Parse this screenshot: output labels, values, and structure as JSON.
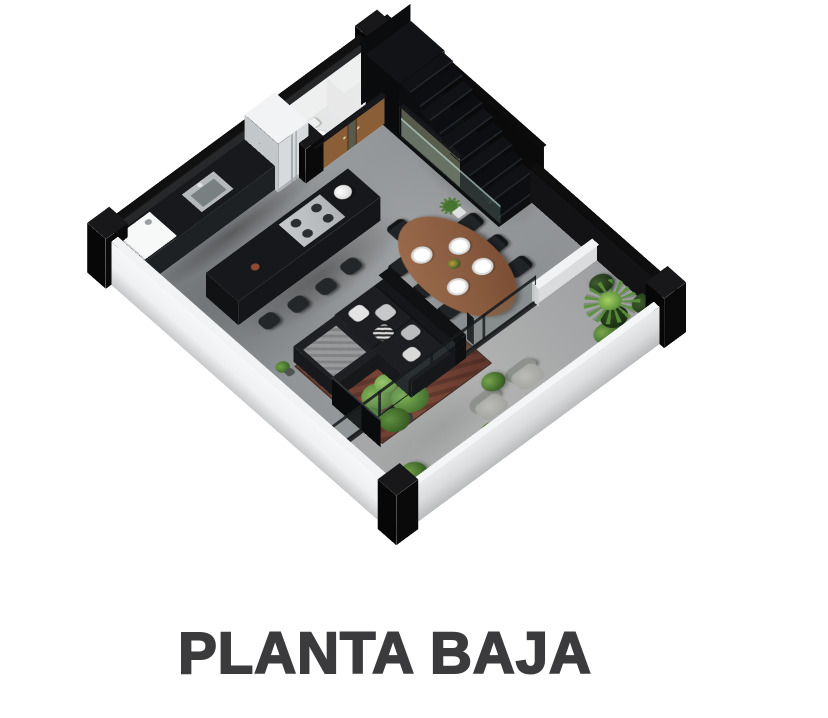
{
  "title": {
    "text": "PLANTA BAJA"
  },
  "palette": {
    "background": "#ffffff",
    "title": "#3b3b3d",
    "floor": "#8f9294",
    "terrace_floor": "#a7a9a9",
    "wall_light": "#eef0f1",
    "wall_dark": "#121214",
    "wall_olive": "#575b4c",
    "door_wood": "#8a5e36",
    "counter_black": "#17191c",
    "table_wood": "#96674a",
    "sofa_black": "#1b1d20",
    "rug_rust": "#714033",
    "plant_green": "#5a8f3a",
    "stairs_black": "#101114",
    "glass": "#9ec9bd"
  },
  "floor_plan": {
    "level_label": "PLANTA BAJA",
    "rooms": [
      {
        "name": "kitchen",
        "items": [
          "washing-machine",
          "sink-counter",
          "refrigerator",
          "kitchen-island",
          "gas-cooktop",
          "bar-stools"
        ],
        "counts": {
          "bar_stools": 4
        }
      },
      {
        "name": "bathrooms",
        "items": [
          "toilet",
          "wood-doors",
          "olive-walls"
        ],
        "counts": {
          "doors": 2
        }
      },
      {
        "name": "dining-room",
        "items": [
          "oval-wood-table",
          "place-settings",
          "chairs"
        ],
        "counts": {
          "plates": 4,
          "chairs": 7
        }
      },
      {
        "name": "living-room",
        "items": [
          "l-shaped-sofa",
          "cushions",
          "throw-blanket",
          "tv-panel",
          "area-rug",
          "fiddle-leaf-plant"
        ]
      },
      {
        "name": "staircase",
        "items": [
          "upper-landing",
          "steps",
          "glass-railing",
          "black-enclosure"
        ],
        "counts": {
          "steps": 10
        }
      },
      {
        "name": "terrace",
        "items": [
          "lounge-chairs",
          "shrubs",
          "palm-plant",
          "glass-partition",
          "low-parapet-wall"
        ],
        "counts": {
          "lounge_chairs": 2
        }
      }
    ]
  }
}
